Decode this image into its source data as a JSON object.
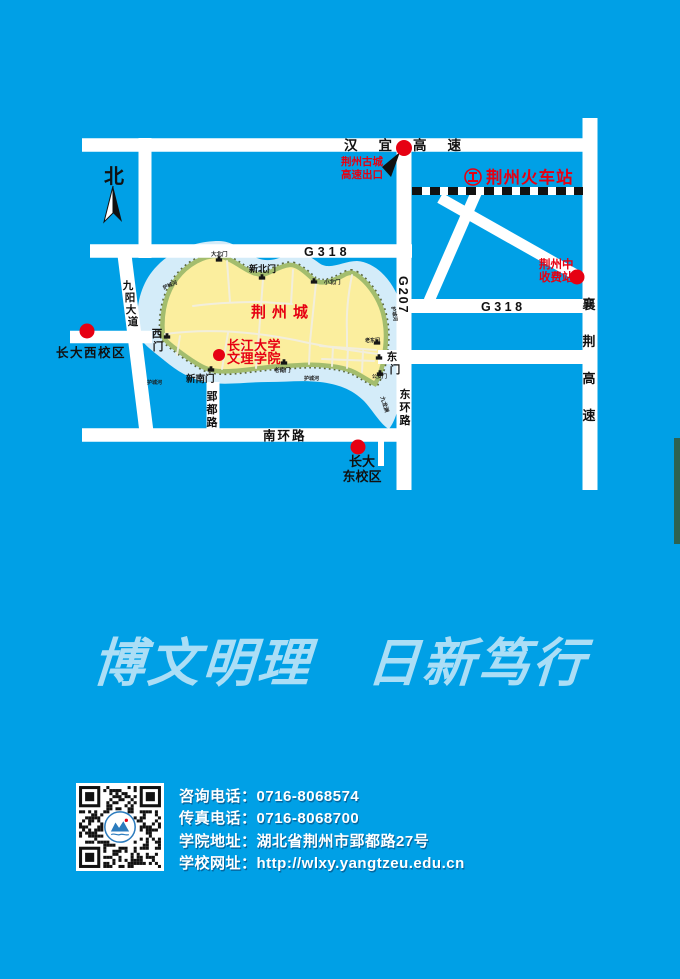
{
  "page": {
    "width": 680,
    "height": 979,
    "background": "#00A0E6"
  },
  "colors": {
    "road_white": "#FFFFFF",
    "city_fill": "#FBEE9E",
    "wall_green": "#A3BD6E",
    "moat_blue": "#D4ECF9",
    "marker_red": "#E60012",
    "label_ink": "#111111",
    "motto_blue": "#ABDEF6",
    "railway_black": "#111111"
  },
  "map": {
    "north": "北",
    "roads": {
      "hanyi": "汉宜高速",
      "g318": "G318",
      "g207": "G207",
      "g318_east": "G318",
      "nanhuan": "南环路",
      "xiangjing_chars": [
        "襄",
        "荆",
        "高",
        "速"
      ],
      "donghuan_chars": [
        "东",
        "环",
        "路"
      ],
      "yingdu_chars": [
        "郢",
        "都",
        "路"
      ],
      "jiuyang_chars": [
        "九",
        "阳",
        "大",
        "道"
      ]
    },
    "places": {
      "city_name": "荆州城",
      "college_line1": "长江大学",
      "college_line2": "文理学院",
      "station": "荆州火车站",
      "exit_line1": "荆州古城",
      "exit_line2": "高速出口",
      "toll_line1": "荆州中",
      "toll_line2": "收费站",
      "west_campus": "长大西校区",
      "east_campus_line1": "长大",
      "east_campus_line2": "东校区"
    },
    "gates": {
      "xinbeimen": "新北门",
      "dabeimen": "大北门",
      "xiaobeimen": "小北门",
      "xinnanmen": "新南门",
      "laonanmen": "老南门",
      "laodongmen": "老东门",
      "gonganmen": "公安门",
      "dongmen_chars": [
        "东",
        "门"
      ],
      "ximen_chars": [
        "西",
        "门"
      ]
    },
    "water": {
      "moat": "护城河",
      "pond": "九龙渊"
    }
  },
  "motto": "博文明理　日新笃行",
  "contact": {
    "lines": [
      {
        "label": "咨询电话：",
        "value": "0716-8068574"
      },
      {
        "label": "传真电话：",
        "value": "0716-8068700"
      },
      {
        "label": "学院地址：",
        "value": "湖北省荆州市郢都路27号"
      },
      {
        "label": "学校网址：",
        "value": "http://wlxy.yangtzeu.edu.cn"
      }
    ]
  }
}
